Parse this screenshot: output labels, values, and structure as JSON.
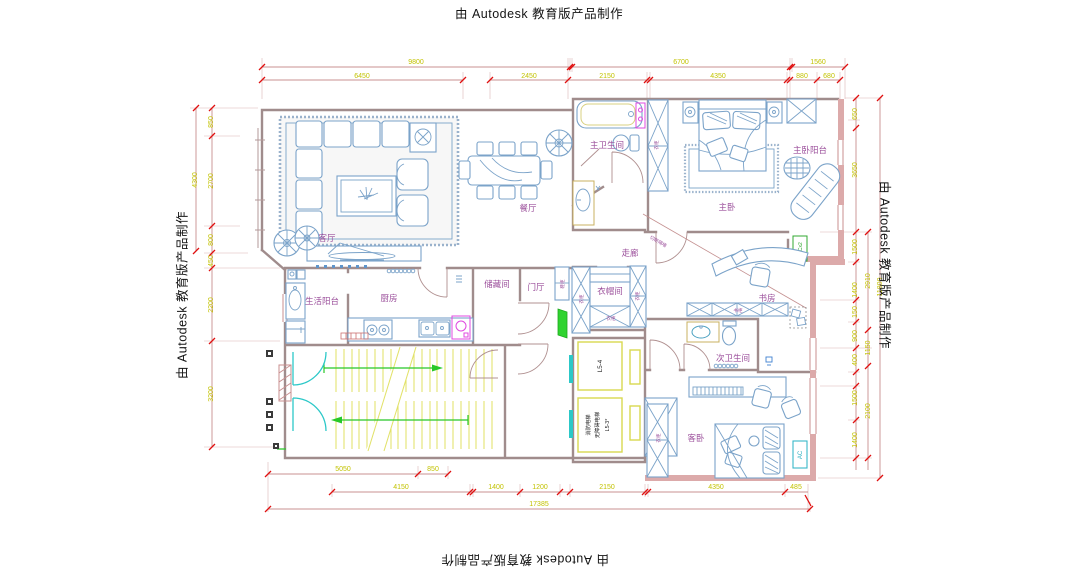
{
  "watermark": "由 Autodesk 教育版产品制作",
  "rooms": {
    "living": "客厅",
    "dining": "餐厅",
    "master_bath": "主卫生间",
    "master_bed": "主卧",
    "master_balcony": "主卧阳台",
    "corridor": "走廊",
    "service_balcony": "生活阳台",
    "kitchen": "厨房",
    "storage": "储藏间",
    "foyer": "门厅",
    "cloakroom": "衣帽间",
    "study": "书房",
    "second_bath": "次卫生间",
    "guest_bed": "客卧"
  },
  "fixtures": {
    "shoe_cabinet": "鞋柜",
    "wardrobe": "衣柜",
    "bookcase": "书柜",
    "partition_note": "切断隔墙",
    "ac_unit": "AC",
    "ac_note": "A.Cx2"
  },
  "elevators": {
    "e1": "L5-4",
    "e2_line1": "消防电梯",
    "e2_line2": "无障碍电梯",
    "e2_line3": "L5-3*"
  },
  "dims": {
    "top1": [
      "9800",
      "6700",
      "1560"
    ],
    "top2": [
      "6450",
      "2450",
      "2150",
      "4350",
      "880",
      "680"
    ],
    "bot1": [
      "5050",
      "850"
    ],
    "bot2": [
      "4150",
      "1400",
      "1200",
      "2150",
      "4350",
      "485"
    ],
    "bot_total": "17385",
    "left_outer": "4300",
    "left_inner": [
      "850",
      "2700",
      "800",
      "450",
      "2200",
      "3200"
    ],
    "right_inner": [
      "650",
      "3650",
      "1500",
      "1400",
      "150",
      "900",
      "400",
      "1500",
      "1400"
    ],
    "right_outer": [
      "2910",
      "1150",
      "2100"
    ],
    "right_total": "11800"
  },
  "colors": {
    "dim_text": "#c2c200",
    "dim_line": "#c89090",
    "tick_red": "#e01010",
    "label_purple": "#9b4f9b",
    "wall_gray": "#a08c8c",
    "wall_pink": "#dcaaaa",
    "furniture_blue": "#7ba3c9",
    "stair_tread_yellow": "#e2e26a",
    "arrow_green": "#28c828",
    "door_cyan": "#2cc8c8",
    "entry_door_green": "#2fd32f",
    "appliance_magenta": "#e048e0",
    "elevator_yell": "#d8d850"
  }
}
